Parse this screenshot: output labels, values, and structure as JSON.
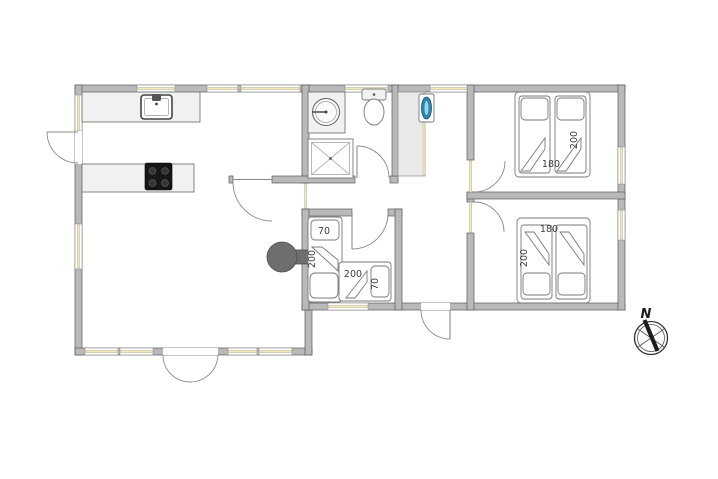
{
  "plan": {
    "type": "holiday-house-floor-plan"
  },
  "colors": {
    "wall-fill": "#b9b9b9",
    "wall-stroke": "#5a5a5a",
    "window-glass": "#f2ecbe",
    "fixture-fill": "#f1f1f1",
    "fixture-stroke": "#787878",
    "stove": "#6e6e6e",
    "cooktop": "#161616",
    "heater-body": "#2f85ad",
    "heater-highlight": "#8ed8f0",
    "label-text": "#3c3c3c",
    "compass": "#1c1c1c"
  },
  "labels": {
    "bedroom1_bed_length": "200",
    "bedroom1_bed_width": "180",
    "bedroom2_bed_width": "180",
    "bedroom2_bed_length": "200",
    "small_room_bed1_width": "70",
    "small_room_bed1_length": "200",
    "small_room_bed2_length": "200",
    "small_room_bed2_width": "70",
    "compass_north": "N"
  }
}
